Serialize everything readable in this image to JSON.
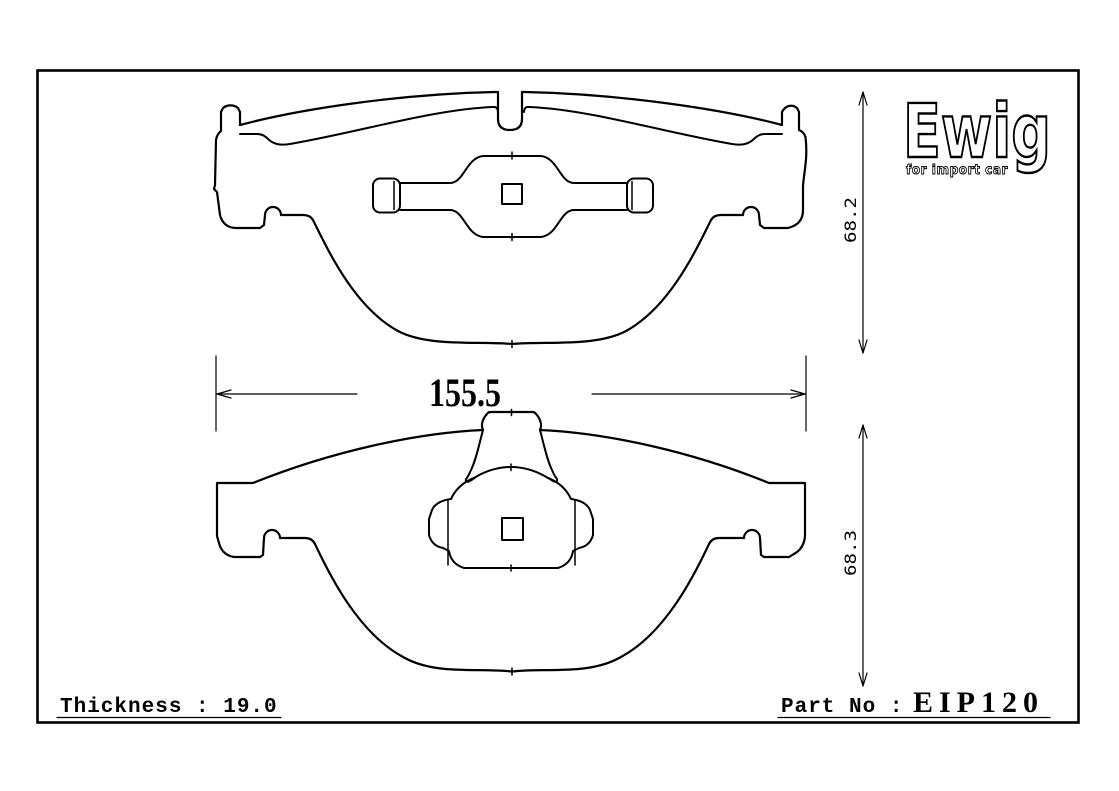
{
  "logo": {
    "brand": "Ewig",
    "tagline": "for import car"
  },
  "dimensions": {
    "pad_width": "155.5",
    "upper_pad_height": "68.2",
    "lower_pad_height": "68.3"
  },
  "footer": {
    "thickness_label": "Thickness : 19.0",
    "part_label": "Part No :",
    "part_number": "EIP120"
  },
  "colors": {
    "line": "#000000",
    "background": "#ffffff"
  }
}
